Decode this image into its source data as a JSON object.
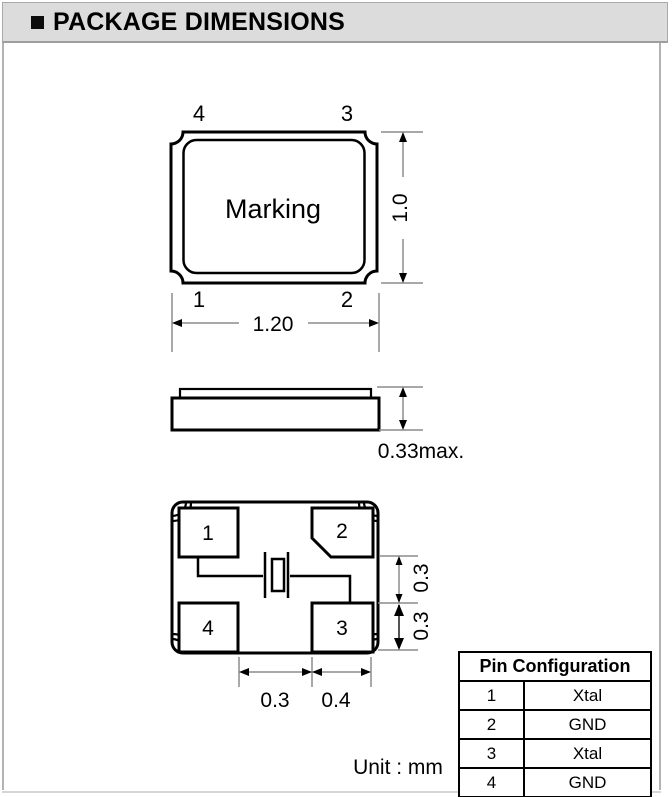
{
  "header": {
    "title": "PACKAGE DIMENSIONS"
  },
  "top_view": {
    "pin_top_left": "4",
    "pin_top_right": "3",
    "pin_bottom_left": "1",
    "pin_bottom_right": "2",
    "marking": "Marking",
    "height_dim": "1.0",
    "width_dim": "1.20"
  },
  "side_view": {
    "thickness_dim": "0.33max."
  },
  "bottom_view": {
    "pad_top_left": "1",
    "pad_top_right": "2",
    "pad_bottom_left": "4",
    "pad_bottom_right": "3",
    "right_upper_dim": "0.3",
    "right_lower_dim": "0.3",
    "bottom_left_dim": "0.3",
    "bottom_right_dim": "0.4"
  },
  "pin_table": {
    "title": "Pin Configuration",
    "rows": [
      {
        "pin": "1",
        "signal": "Xtal"
      },
      {
        "pin": "2",
        "signal": "GND"
      },
      {
        "pin": "3",
        "signal": "Xtal"
      },
      {
        "pin": "4",
        "signal": "GND"
      }
    ]
  },
  "footer": {
    "unit_label": "Unit : mm"
  },
  "colors": {
    "header_bg": "#dcdcdc",
    "frame_border": "#b3b3b3",
    "line": "#000000",
    "dim_line": "#8c8c8c"
  }
}
